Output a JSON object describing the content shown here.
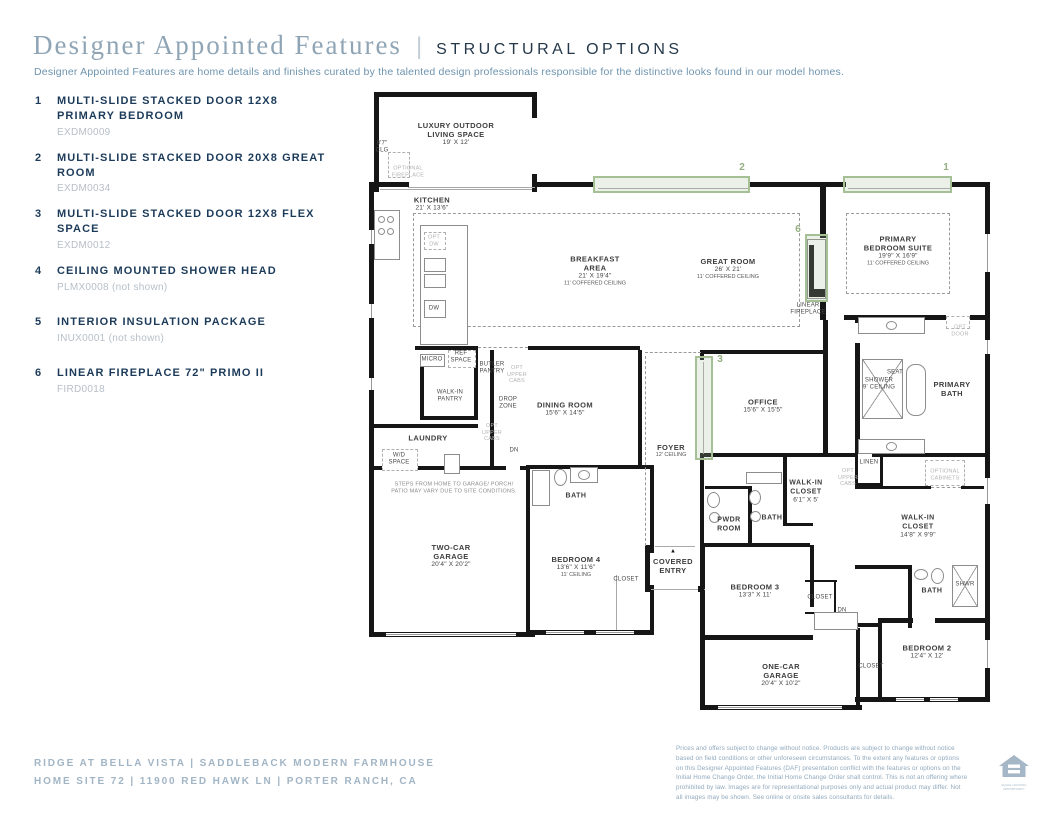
{
  "header": {
    "title": "Designer Appointed Features",
    "divider": "|",
    "section": "STRUCTURAL OPTIONS",
    "description": "Designer Appointed Features are home details and finishes curated by the talented design professionals responsible for the distinctive looks found in our model homes."
  },
  "features": [
    {
      "num": "1",
      "title": "MULTI-SLIDE STACKED DOOR 12X8 PRIMARY BEDROOM",
      "code": "EXDM0009"
    },
    {
      "num": "2",
      "title": "MULTI-SLIDE STACKED DOOR 20X8 GREAT ROOM",
      "code": "EXDM0034"
    },
    {
      "num": "3",
      "title": "MULTI-SLIDE STACKED DOOR 12X8 FLEX SPACE",
      "code": "EXDM0012"
    },
    {
      "num": "4",
      "title": "CEILING MOUNTED SHOWER HEAD",
      "code": "PLMX0008 (not shown)"
    },
    {
      "num": "5",
      "title": "INTERIOR INSULATION PACKAGE",
      "code": "INUX0001 (not shown)"
    },
    {
      "num": "6",
      "title": "LINEAR FIREPLACE 72\" PRIMO II",
      "code": "FIRD0018"
    }
  ],
  "plan": {
    "colors": {
      "option_highlight": "#a6c096",
      "marker_text": "#94ae81",
      "wall": "#161616"
    },
    "markers": [
      "1",
      "2",
      "3",
      "6"
    ],
    "labels": [
      {
        "id": "outdoor",
        "lines": [
          [
            "LUXURY OUTDOOR",
            "n"
          ],
          [
            "LIVING SPACE",
            "n"
          ],
          [
            "19' X 12'",
            "d"
          ]
        ]
      },
      {
        "id": "clg87",
        "lines": [
          [
            "8'7\"",
            "s"
          ],
          [
            "CLG",
            "s"
          ]
        ]
      },
      {
        "id": "optfp",
        "lines": [
          [
            "OPTIONAL",
            "g"
          ],
          [
            "FIREPLACE",
            "g"
          ]
        ]
      },
      {
        "id": "kitchen",
        "lines": [
          [
            "KITCHEN",
            "n"
          ],
          [
            "21' X 13'6\"",
            "d"
          ]
        ]
      },
      {
        "id": "breakfast",
        "lines": [
          [
            "BREAKFAST",
            "n"
          ],
          [
            "AREA",
            "n"
          ],
          [
            "21' X 19'4\"",
            "d"
          ],
          [
            "11' COFFERED CEILING",
            "c"
          ]
        ]
      },
      {
        "id": "great",
        "lines": [
          [
            "GREAT ROOM",
            "n"
          ],
          [
            "26' X 21'",
            "d"
          ],
          [
            "11' COFFERED CEILING",
            "c"
          ]
        ]
      },
      {
        "id": "psuite",
        "lines": [
          [
            "PRIMARY",
            "n"
          ],
          [
            "BEDROOM SUITE",
            "n"
          ],
          [
            "19'9\" X 16'9\"",
            "d"
          ],
          [
            "11' COFFERED CEILING",
            "c"
          ]
        ]
      },
      {
        "id": "linfp",
        "lines": [
          [
            "LINEAR",
            "s"
          ],
          [
            "FIREPLACE",
            "s"
          ]
        ]
      },
      {
        "id": "optdw",
        "lines": [
          [
            "OPT",
            "g"
          ],
          [
            "DW",
            "g"
          ]
        ]
      },
      {
        "id": "dw",
        "lines": [
          [
            "DW",
            "s"
          ]
        ]
      },
      {
        "id": "micro",
        "lines": [
          [
            "MICRO",
            "s"
          ]
        ]
      },
      {
        "id": "ref",
        "lines": [
          [
            "REF",
            "s"
          ],
          [
            "SPACE",
            "s"
          ]
        ]
      },
      {
        "id": "butler",
        "lines": [
          [
            "BUTLER",
            "s"
          ],
          [
            "PANTRY",
            "s"
          ]
        ]
      },
      {
        "id": "optcabs1",
        "lines": [
          [
            "OPT",
            "g"
          ],
          [
            "UPPER",
            "g"
          ],
          [
            "CABS",
            "g"
          ]
        ]
      },
      {
        "id": "wip",
        "lines": [
          [
            "WALK-IN",
            "s"
          ],
          [
            "PANTRY",
            "s"
          ]
        ]
      },
      {
        "id": "dropzone",
        "lines": [
          [
            "DROP",
            "s"
          ],
          [
            "ZONE",
            "s"
          ]
        ]
      },
      {
        "id": "optcabs2",
        "lines": [
          [
            "OPT",
            "g"
          ],
          [
            "UPPER",
            "g"
          ],
          [
            "CABS",
            "g"
          ]
        ]
      },
      {
        "id": "laundry",
        "lines": [
          [
            "LAUNDRY",
            "n"
          ]
        ]
      },
      {
        "id": "wd",
        "lines": [
          [
            "W/D",
            "s"
          ],
          [
            "SPACE",
            "s"
          ]
        ]
      },
      {
        "id": "dn1",
        "lines": [
          [
            "DN",
            "s"
          ]
        ]
      },
      {
        "id": "steps",
        "lines": [
          [
            "STEPS FROM HOME TO GARAGE/ PORCH/",
            "t"
          ],
          [
            "PATIO MAY VARY DUE TO SITE CONDITIONS.",
            "t"
          ]
        ]
      },
      {
        "id": "dining",
        "lines": [
          [
            "DINING ROOM",
            "n"
          ],
          [
            "15'6\" X 14'5\"",
            "d"
          ]
        ]
      },
      {
        "id": "office",
        "lines": [
          [
            "OFFICE",
            "n"
          ],
          [
            "15'6\" X 15'5\"",
            "d"
          ]
        ]
      },
      {
        "id": "foyer",
        "lines": [
          [
            "FOYER",
            "n"
          ],
          [
            "12' CEILING",
            "c"
          ]
        ]
      },
      {
        "id": "bathb4",
        "lines": [
          [
            "BATH",
            "b"
          ]
        ]
      },
      {
        "id": "tcg",
        "lines": [
          [
            "TWO-CAR",
            "n"
          ],
          [
            "GARAGE",
            "n"
          ],
          [
            "20'4\" X 20'2\"",
            "d"
          ]
        ]
      },
      {
        "id": "bed4",
        "lines": [
          [
            "BEDROOM 4",
            "n"
          ],
          [
            "13'6\" X 11'6\"",
            "d"
          ],
          [
            "11' CEILING",
            "c"
          ]
        ]
      },
      {
        "id": "closetb4",
        "lines": [
          [
            "CLOSET",
            "s"
          ]
        ]
      },
      {
        "id": "entry",
        "lines": [
          [
            "COVERED",
            "n"
          ],
          [
            "ENTRY",
            "n"
          ]
        ]
      },
      {
        "id": "arrow",
        "lines": [
          [
            "▲",
            "a"
          ]
        ]
      },
      {
        "id": "pwdr",
        "lines": [
          [
            "PWDR",
            "b"
          ],
          [
            "ROOM",
            "b"
          ]
        ]
      },
      {
        "id": "bathmid",
        "lines": [
          [
            "BATH",
            "b"
          ]
        ]
      },
      {
        "id": "wicsmall",
        "lines": [
          [
            "WALK-IN",
            "b"
          ],
          [
            "CLOSET",
            "b"
          ],
          [
            "6'1\" X 5'",
            "d"
          ]
        ]
      },
      {
        "id": "bed3",
        "lines": [
          [
            "BEDROOM 3",
            "n"
          ],
          [
            "13'3\" X 11'",
            "d"
          ]
        ]
      },
      {
        "id": "closetb3",
        "lines": [
          [
            "CLOSET",
            "s"
          ]
        ]
      },
      {
        "id": "dn2",
        "lines": [
          [
            "DN",
            "s"
          ]
        ]
      },
      {
        "id": "ocg",
        "lines": [
          [
            "ONE-CAR",
            "n"
          ],
          [
            "GARAGE",
            "n"
          ],
          [
            "20'4\" X 10'2\"",
            "d"
          ]
        ]
      },
      {
        "id": "closetb2",
        "lines": [
          [
            "CLOSET",
            "s"
          ]
        ]
      },
      {
        "id": "bed2",
        "lines": [
          [
            "BEDROOM 2",
            "n"
          ],
          [
            "12'4\" X 12'",
            "d"
          ]
        ]
      },
      {
        "id": "bathb2",
        "lines": [
          [
            "BATH",
            "b"
          ]
        ]
      },
      {
        "id": "shwr",
        "lines": [
          [
            "SHWR",
            "s"
          ]
        ]
      },
      {
        "id": "wicprim",
        "lines": [
          [
            "WALK-IN",
            "b"
          ],
          [
            "CLOSET",
            "b"
          ],
          [
            "14'8\" X 9'9\"",
            "d"
          ]
        ]
      },
      {
        "id": "linen",
        "lines": [
          [
            "LINEN",
            "s"
          ]
        ]
      },
      {
        "id": "optcabs3",
        "lines": [
          [
            "OPT",
            "g"
          ],
          [
            "UPPER",
            "g"
          ],
          [
            "CABS",
            "g"
          ]
        ]
      },
      {
        "id": "optcabinets",
        "lines": [
          [
            "OPTIONAL",
            "g"
          ],
          [
            "CABINETS",
            "g"
          ]
        ]
      },
      {
        "id": "pbath",
        "lines": [
          [
            "PRIMARY",
            "n"
          ],
          [
            "BATH",
            "n"
          ]
        ]
      },
      {
        "id": "shower9",
        "lines": [
          [
            "SHOWER",
            "s"
          ],
          [
            "9' CEILING",
            "s"
          ]
        ]
      },
      {
        "id": "seat",
        "lines": [
          [
            "SEAT",
            "s"
          ]
        ]
      },
      {
        "id": "optdoor",
        "lines": [
          [
            "OPT",
            "g"
          ],
          [
            "DOOR",
            "g"
          ]
        ]
      },
      {
        "id": "m1",
        "lines": [
          [
            "1",
            "m"
          ]
        ]
      },
      {
        "id": "m2",
        "lines": [
          [
            "2",
            "m"
          ]
        ]
      },
      {
        "id": "m3",
        "lines": [
          [
            "3",
            "m"
          ]
        ]
      },
      {
        "id": "m6",
        "lines": [
          [
            "6",
            "m"
          ]
        ]
      }
    ]
  },
  "footer": {
    "community": "RIDGE AT BELLA VISTA | SADDLEBACK MODERN FARMHOUSE",
    "address": "HOME SITE 72 | 11900 RED HAWK LN | PORTER RANCH, CA",
    "disclaimer": "Prices and offers subject to change without notice. Products are subject to change without notice based on field conditions or other unforeseen circumstances. To the extent any features or options on this Designer Appointed Features (DAF) presentation conflict with the features or options on the Initial Home Change Order, the Initial Home Change Order shall control. This is not an offering where prohibited by law. Images are for representational purposes only and actual product may differ. Not all images may be shown. See online or onsite sales consultants for details.",
    "logo_caption": "EQUAL HOUSING OPPORTUNITY"
  }
}
